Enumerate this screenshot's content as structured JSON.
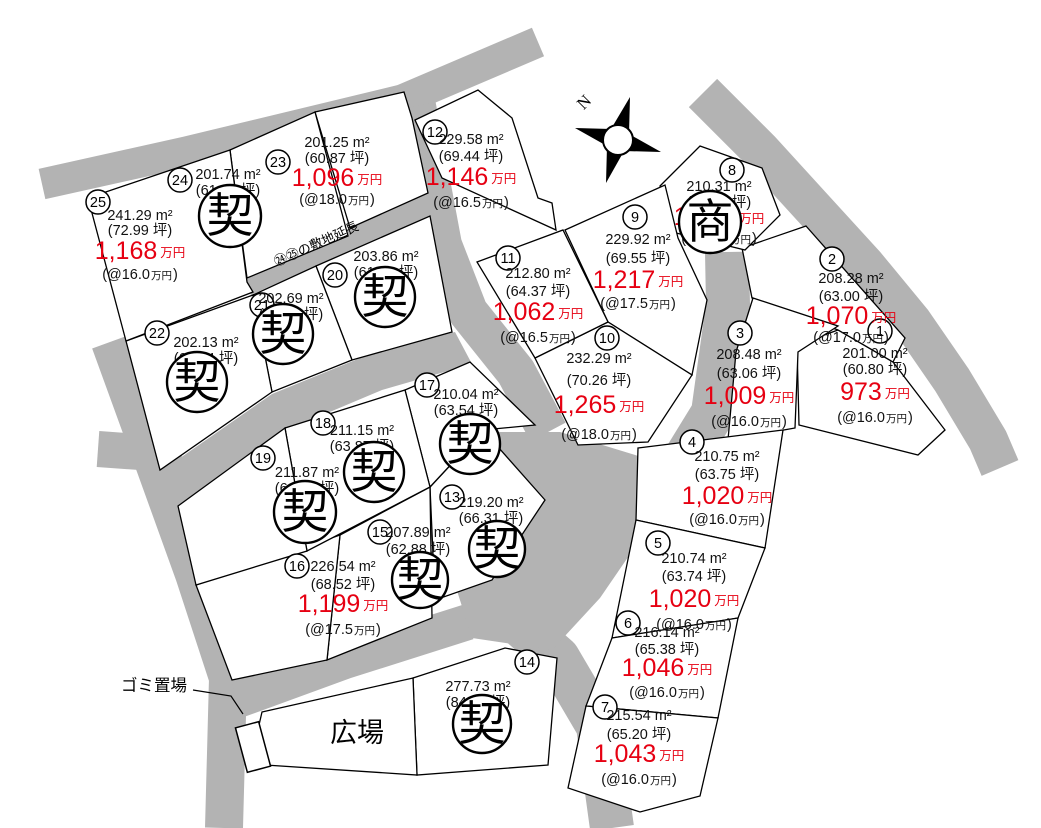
{
  "colors": {
    "road": "#b3b3b3",
    "price_red": "#e60012",
    "line": "#000000",
    "background": "#ffffff"
  },
  "legend": {
    "sold_mark": "契",
    "commercial_mark": "商"
  },
  "labels": {
    "plaza": "広場",
    "garbage_station": "ゴミ置場",
    "flagpole_strip": "㉔㉕の敷地延長",
    "compass_north": "N"
  },
  "lots": [
    {
      "n": "1",
      "area": "201.00 m²",
      "tsubo": "(60.80 坪)",
      "price": "973",
      "currency": "万円",
      "unit": "(@16.0万円)",
      "status": "available"
    },
    {
      "n": "2",
      "area": "208.28 m²",
      "tsubo": "(63.00 坪)",
      "price": "1,070",
      "currency": "万円",
      "unit": "(@17.0万円)",
      "status": "available"
    },
    {
      "n": "3",
      "area": "208.48 m²",
      "tsubo": "(63.06 坪)",
      "price": "1,009",
      "currency": "万円",
      "unit": "(@16.0万円)",
      "status": "available"
    },
    {
      "n": "4",
      "area": "210.75 m²",
      "tsubo": "(63.75 坪)",
      "price": "1,020",
      "currency": "万円",
      "unit": "(@16.0万円)",
      "status": "available"
    },
    {
      "n": "5",
      "area": "210.74 m²",
      "tsubo": "(63.74 坪)",
      "price": "1,020",
      "currency": "万円",
      "unit": "(@16.0万円)",
      "status": "available"
    },
    {
      "n": "6",
      "area": "216.14 m²",
      "tsubo": "(65.38 坪)",
      "price": "1,046",
      "currency": "万円",
      "unit": "(@16.0万円)",
      "status": "available"
    },
    {
      "n": "7",
      "area": "215.54 m²",
      "tsubo": "(65.20 坪)",
      "price": "1,043",
      "currency": "万円",
      "unit": "(@16.0万円)",
      "status": "available"
    },
    {
      "n": "8",
      "area": "210.31 m²",
      "tsubo": "(63.61 坪)",
      "price": "1,050",
      "currency": "万円",
      "unit": "(@16.5万円)",
      "status": "commercial"
    },
    {
      "n": "9",
      "area": "229.92 m²",
      "tsubo": "(69.55 坪)",
      "price": "1,217",
      "currency": "万円",
      "unit": "(@17.5万円)",
      "status": "available"
    },
    {
      "n": "10",
      "area": "232.29 m²",
      "tsubo": "(70.26 坪)",
      "price": "1,265",
      "currency": "万円",
      "unit": "(@18.0万円)",
      "status": "available"
    },
    {
      "n": "11",
      "area": "212.80 m²",
      "tsubo": "(64.37 坪)",
      "price": "1,062",
      "currency": "万円",
      "unit": "(@16.5万円)",
      "status": "available"
    },
    {
      "n": "12",
      "area": "229.58 m²",
      "tsubo": "(69.44 坪)",
      "price": "1,146",
      "currency": "万円",
      "unit": "(@16.5万円)",
      "status": "available"
    },
    {
      "n": "13",
      "area": "219.20 m²",
      "tsubo": "(66.31 坪)",
      "price": null,
      "currency": null,
      "unit": null,
      "status": "sold"
    },
    {
      "n": "14",
      "area": "277.73 m²",
      "tsubo": "(84.01 坪)",
      "price": null,
      "currency": null,
      "unit": null,
      "status": "sold"
    },
    {
      "n": "15",
      "area": "207.89 m²",
      "tsubo": "(62.88 坪)",
      "price": null,
      "currency": null,
      "unit": null,
      "status": "sold"
    },
    {
      "n": "16",
      "area": "226.54 m²",
      "tsubo": "(68.52 坪)",
      "price": "1,199",
      "currency": "万円",
      "unit": "(@17.5万円)",
      "status": "available"
    },
    {
      "n": "17",
      "area": "210.04 m²",
      "tsubo": "(63.54 坪)",
      "price": null,
      "currency": null,
      "unit": null,
      "status": "sold"
    },
    {
      "n": "18",
      "area": "211.15 m²",
      "tsubo": "(63.87 坪)",
      "price": null,
      "currency": null,
      "unit": null,
      "status": "sold"
    },
    {
      "n": "19",
      "area": "211.87 m²",
      "tsubo": "(64.09 坪)",
      "price": null,
      "currency": null,
      "unit": null,
      "status": "sold"
    },
    {
      "n": "20",
      "area": "203.86 m²",
      "tsubo": "(61.66 坪)",
      "price": null,
      "currency": null,
      "unit": null,
      "status": "sold"
    },
    {
      "n": "21",
      "area": "202.69 m²",
      "tsubo": "(61.31 坪)",
      "price": null,
      "currency": null,
      "unit": null,
      "status": "sold"
    },
    {
      "n": "22",
      "area": "202.13 m²",
      "tsubo": "(61.14 坪)",
      "price": null,
      "currency": null,
      "unit": null,
      "status": "sold"
    },
    {
      "n": "23",
      "area": "201.25 m²",
      "tsubo": "(60.87 坪)",
      "price": "1,096",
      "currency": "万円",
      "unit": "(@18.0万円)",
      "status": "available"
    },
    {
      "n": "24",
      "area": "201.74 m²",
      "tsubo": "(61.02 坪)",
      "price": null,
      "currency": null,
      "unit": null,
      "status": "sold"
    },
    {
      "n": "25",
      "area": "241.29 m²",
      "tsubo": "(72.99 坪)",
      "price": "1,168",
      "currency": "万円",
      "unit": "(@16.0万円)",
      "status": "available"
    }
  ]
}
